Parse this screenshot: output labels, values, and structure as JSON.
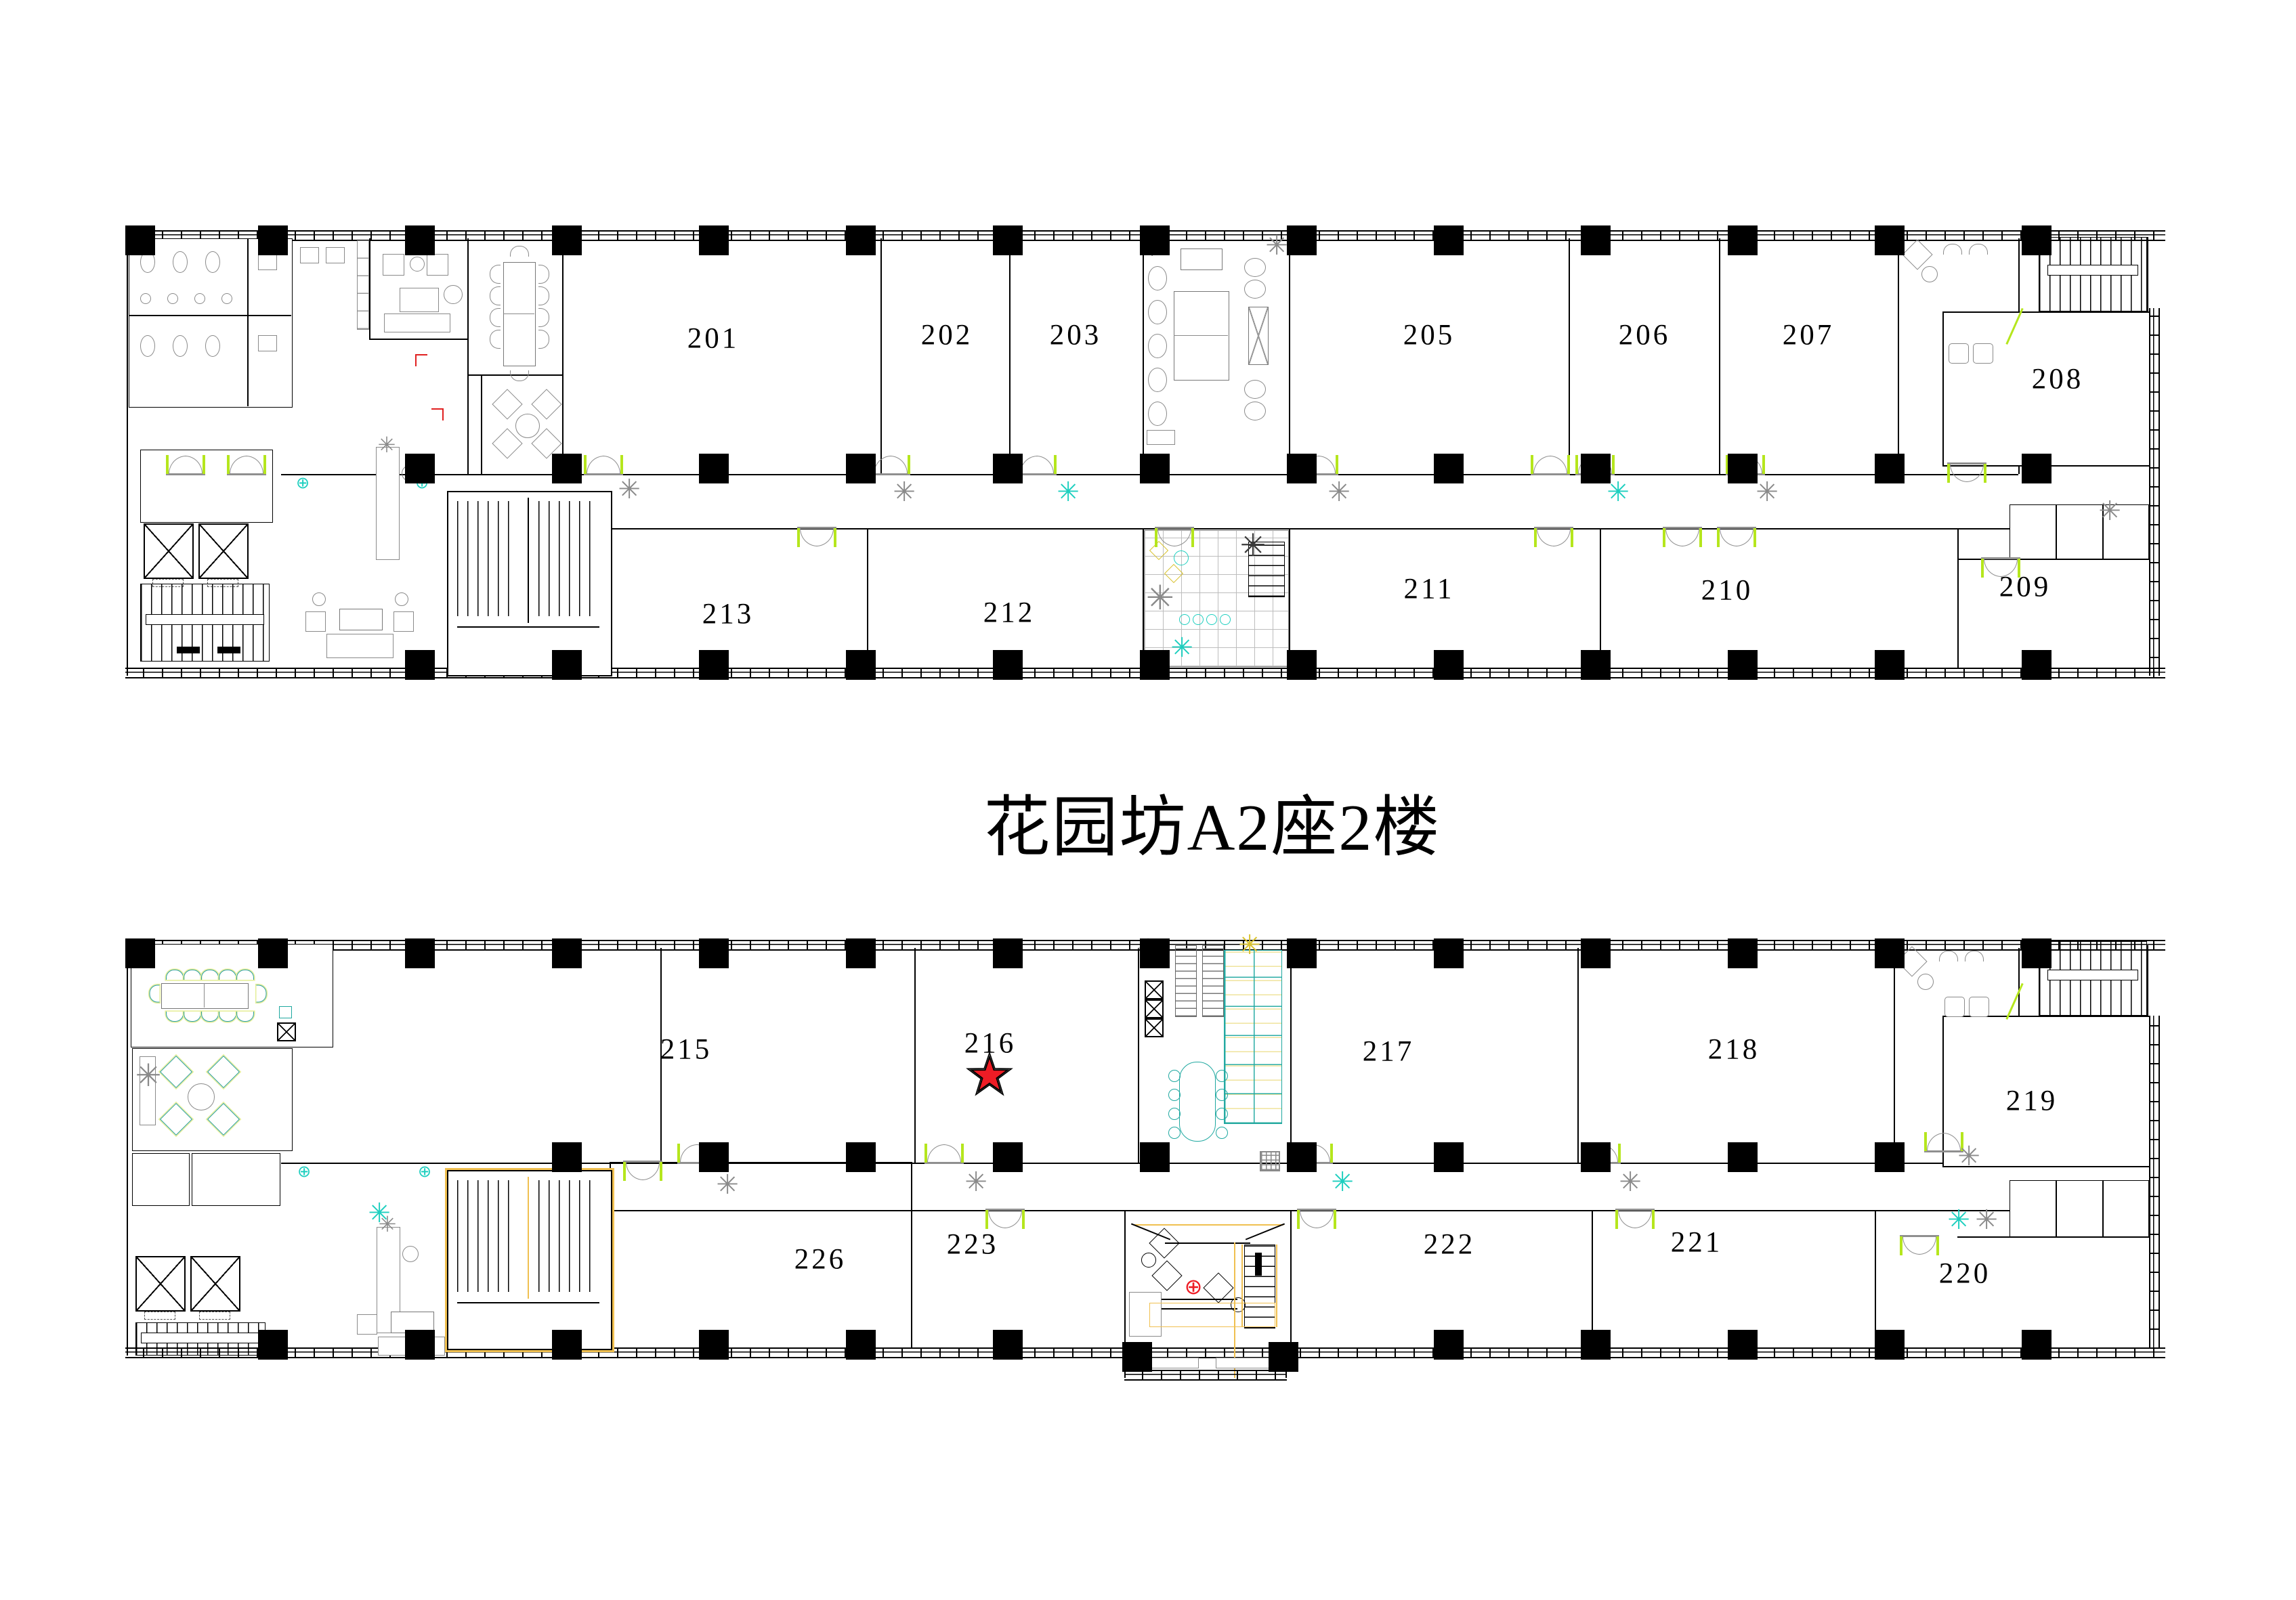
{
  "title": "花园坊A2座2楼",
  "floors": [
    {
      "name": "upper-strip",
      "top_rooms": [
        "201",
        "202",
        "203",
        "205",
        "206",
        "207",
        "208"
      ],
      "bottom_rooms": [
        "213",
        "212",
        "211",
        "210",
        "209"
      ]
    },
    {
      "name": "lower-strip",
      "top_rooms": [
        "215",
        "216",
        "217",
        "218",
        "219"
      ],
      "bottom_rooms": [
        "226",
        "223",
        "222",
        "221",
        "220"
      ]
    }
  ],
  "marker": {
    "room": "216",
    "shape": "star",
    "fill": "#ee1c25",
    "outline": "#000000"
  },
  "icons": {
    "plant": "✳",
    "target": "⊕"
  },
  "colors": {
    "wall": "#000000",
    "furniture_gray": "#8a8a8a",
    "door_accent": "#b5e61d",
    "teal": "#1ecfbf",
    "highlight_yellow": "#f0c050",
    "marker_red": "#ee1c25"
  }
}
